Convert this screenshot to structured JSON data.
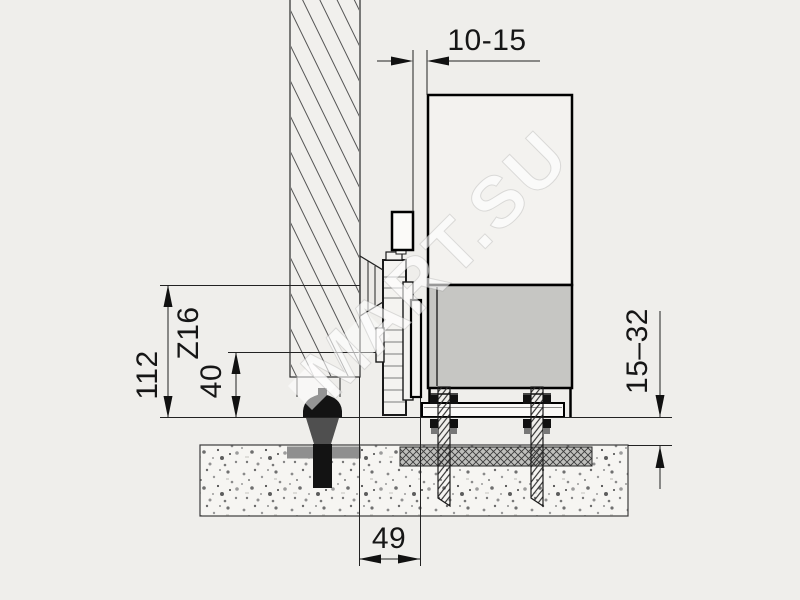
{
  "drawing": {
    "watermark": "MART.SU",
    "dimensions": {
      "top_gap": "10-15",
      "height_total": "112",
      "bracket_code": "Z16",
      "height_inner": "40",
      "ground_clearance": "15–32",
      "bottom_offset": "49"
    },
    "colors": {
      "background": "#efeeeb",
      "panel_light": "#f3f2ef",
      "panel_gray": "#c6c6c3",
      "carriage_fill": "#f4f3f0",
      "line": "#1a1a1a",
      "anchor_black": "#131313",
      "anchor_wedge": "#4f4f4f",
      "washer_gray": "#8f8f8f"
    }
  }
}
